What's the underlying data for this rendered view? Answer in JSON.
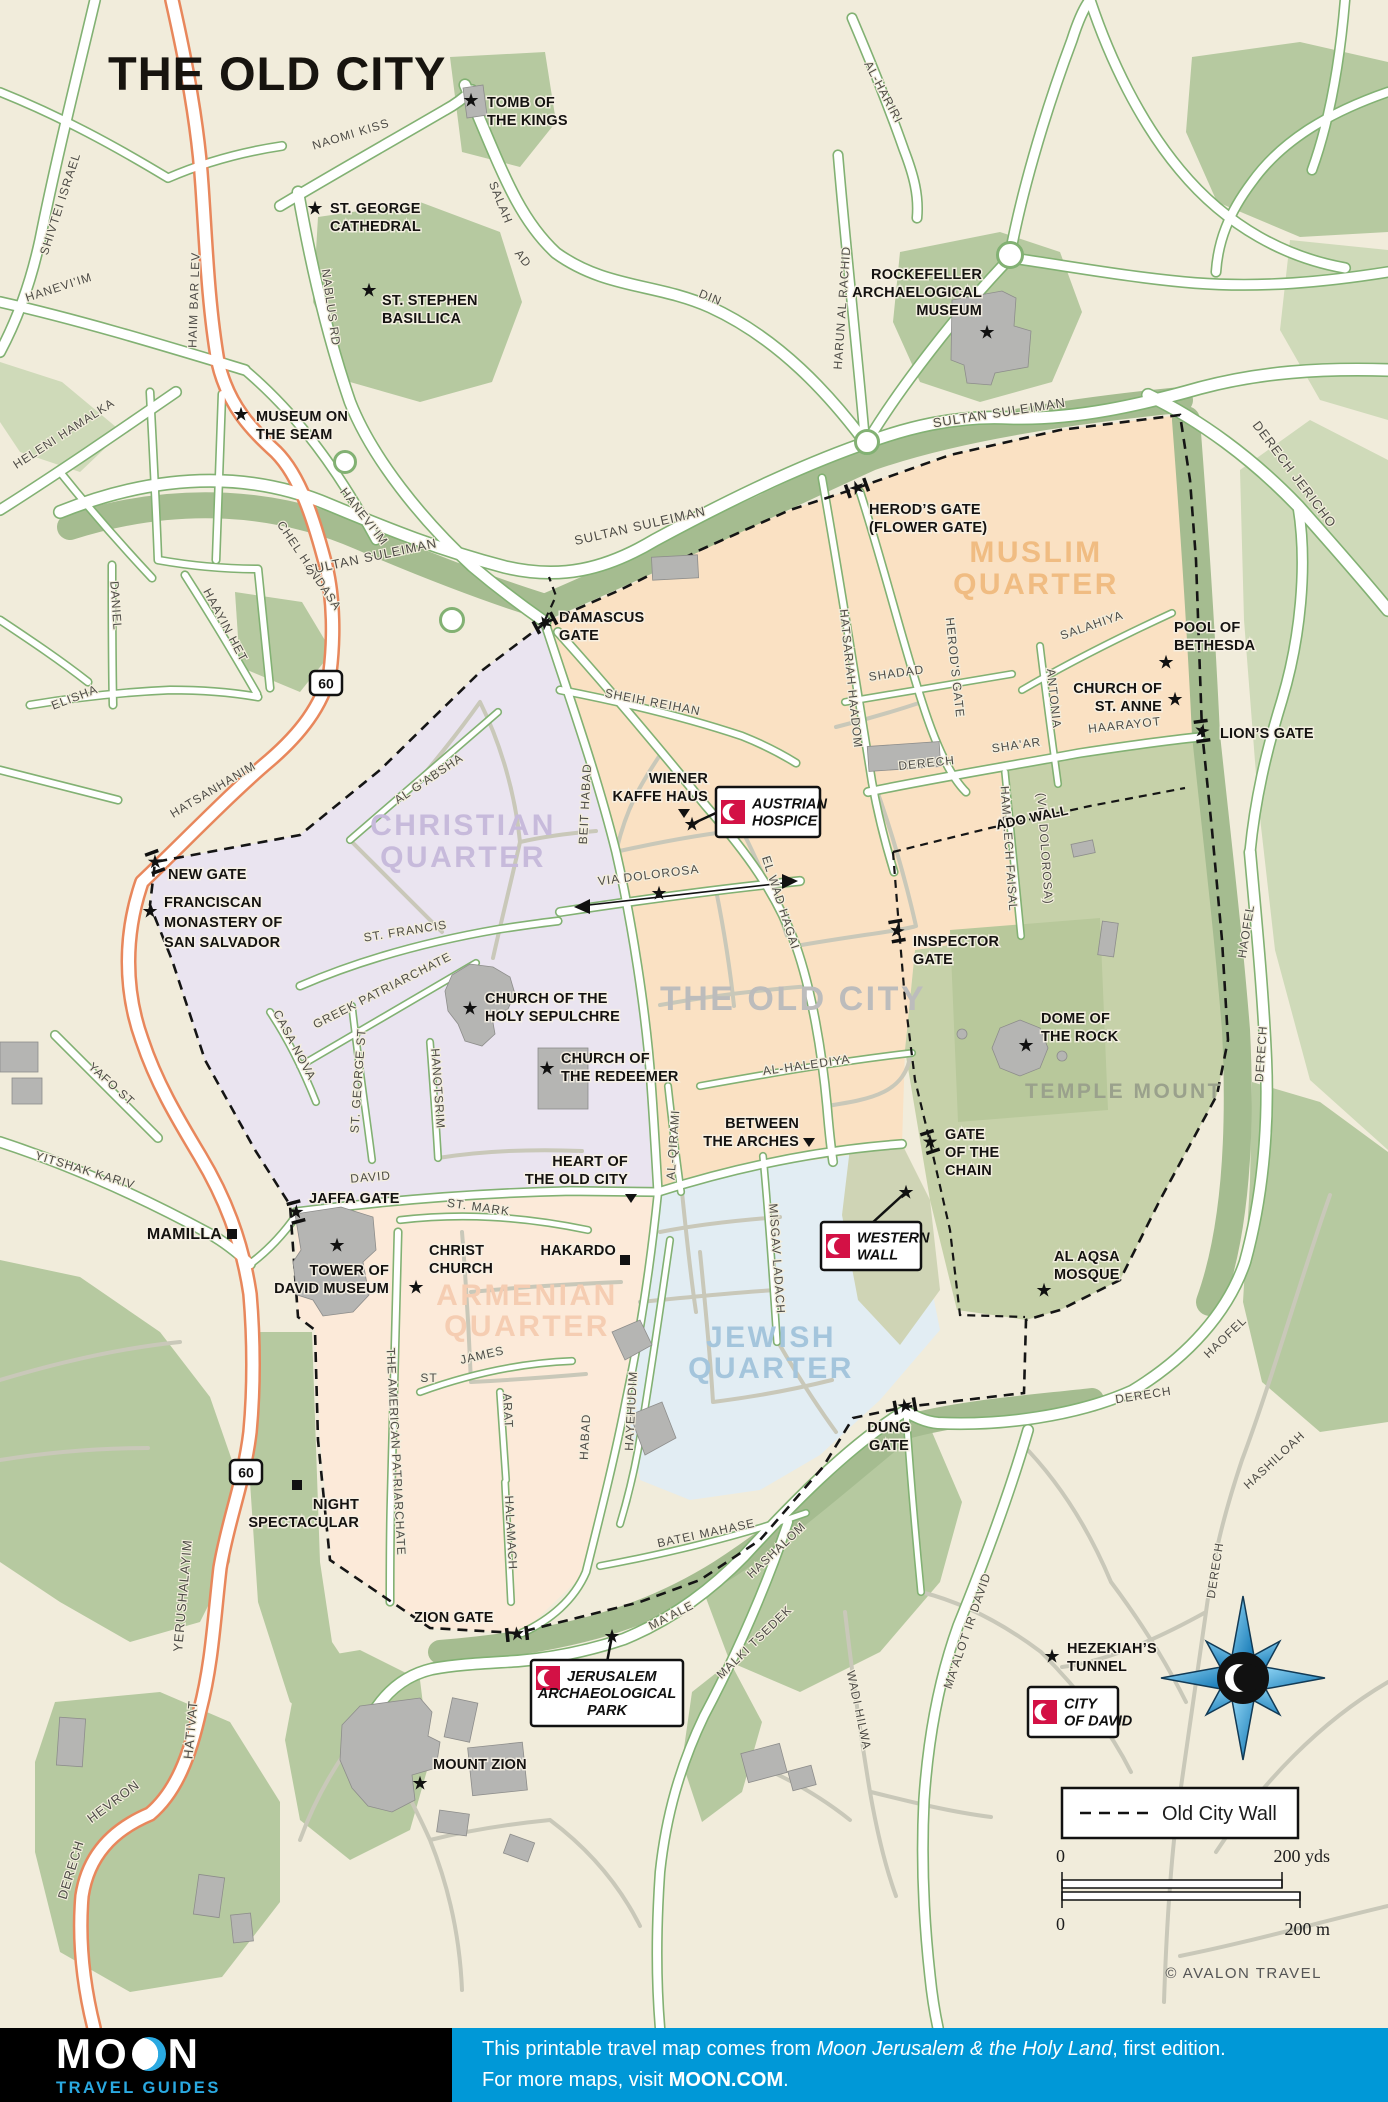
{
  "title": "THE OLD CITY",
  "copyright": "© AVALON TRAVEL",
  "colors": {
    "background": "#f1ecdb",
    "road_casing_green": "#82b173",
    "road_casing_orange": "#e8875c",
    "road_casing_pale": "#c5c8b2",
    "green_area": "#b6c9a0",
    "green_area_light": "#cfdab9",
    "green_band": "#a5bc90",
    "muslim_quarter": "#fae1c3",
    "christian_quarter": "#eae4f0",
    "armenian_quarter": "#fcead9",
    "jewish_quarter": "#e2edf3",
    "temple_mount": "#c6d1a9",
    "temple_platform": "#b8c89b",
    "western_wall_plaza": "#cfd4b5",
    "building_gray": "#b5b5b3",
    "sight_red": "#d31145",
    "footer_blue": "#0098d7",
    "logo_blue": "#2aa9e1"
  },
  "map": {
    "legend": {
      "label": "Old City Wall"
    },
    "scale": {
      "zero_top": "0",
      "yds": "200 yds",
      "zero_bottom": "0",
      "m": "200 m"
    },
    "compass": {
      "x": 1243,
      "y": 1678
    },
    "route_shields": [
      {
        "text": "60",
        "x": 326,
        "y": 683
      },
      {
        "text": "60",
        "x": 246,
        "y": 1472
      }
    ],
    "quarter_labels": [
      {
        "lines": [
          "MUSLIM",
          "QUARTER"
        ],
        "x": 1036,
        "y": 562,
        "color": "#f0bc82",
        "size": 30,
        "lh": 32
      },
      {
        "lines": [
          "CHRISTIAN",
          "QUARTER"
        ],
        "x": 463,
        "y": 835,
        "color": "#c7badb",
        "size": 30,
        "lh": 32
      },
      {
        "lines": [
          "ARMENIAN",
          "QUARTER"
        ],
        "x": 527,
        "y": 1305,
        "color": "#f5cdb2",
        "size": 30,
        "lh": 31
      },
      {
        "lines": [
          "JEWISH",
          "QUARTER"
        ],
        "x": 771,
        "y": 1347,
        "color": "#a4c5dc",
        "size": 30,
        "lh": 31
      },
      {
        "lines": [
          "THE OLD CITY"
        ],
        "x": 793,
        "y": 1010,
        "color": "#bcbcbc",
        "size": 34,
        "lh": 34
      },
      {
        "lines": [
          "TEMPLE MOUNT"
        ],
        "x": 1124,
        "y": 1098,
        "color": "#9aa18c",
        "size": 21,
        "lh": 21
      }
    ],
    "street_labels": [
      {
        "t": "NAOMI KISS",
        "x": 352,
        "y": 138,
        "r": -17
      },
      {
        "t": "SHIVTEI ISRAEL",
        "x": 64,
        "y": 205,
        "r": -72
      },
      {
        "t": "HAIM BAR LEV",
        "x": 198,
        "y": 300,
        "r": -88
      },
      {
        "t": "NABLUS RD",
        "x": 327,
        "y": 308,
        "r": 82
      },
      {
        "t": "SALAH",
        "x": 497,
        "y": 204,
        "r": 68
      },
      {
        "t": "AD",
        "x": 520,
        "y": 261,
        "r": 52
      },
      {
        "t": "DIN",
        "x": 709,
        "y": 301,
        "r": 22
      },
      {
        "t": "AL-HARIRI",
        "x": 880,
        "y": 94,
        "r": 62
      },
      {
        "t": "HARUN AL RACHID",
        "x": 846,
        "y": 308,
        "r": -86
      },
      {
        "t": "HANEVI'IM",
        "x": 60,
        "y": 291,
        "r": -18
      },
      {
        "t": "HANEVI'IM",
        "x": 361,
        "y": 519,
        "r": 52
      },
      {
        "t": "HELENI HAMALKA",
        "x": 66,
        "y": 437,
        "r": -33
      },
      {
        "t": "CHEL HANDASA",
        "x": 306,
        "y": 568,
        "r": 56
      },
      {
        "t": "DANIEL",
        "x": 112,
        "y": 606,
        "r": 86
      },
      {
        "t": "ELISHA",
        "x": 76,
        "y": 701,
        "r": -21
      },
      {
        "t": "HAAYIN HET",
        "x": 222,
        "y": 627,
        "r": 62
      },
      {
        "t": "HATSANHANIM",
        "x": 215,
        "y": 793,
        "r": -31
      },
      {
        "t": "SULTAN SULEIMAN",
        "x": 372,
        "y": 561,
        "r": -12,
        "s": 13
      },
      {
        "t": "SULTAN SULEIMAN",
        "x": 641,
        "y": 530,
        "r": -13,
        "s": 13
      },
      {
        "t": "SULTAN SULEIMAN",
        "x": 1000,
        "y": 417,
        "r": -9,
        "s": 13
      },
      {
        "t": "DERECH JERICHO",
        "x": 1291,
        "y": 477,
        "r": 53,
        "s": 13
      },
      {
        "t": "SHEIH REIHAN",
        "x": 652,
        "y": 706,
        "r": 11
      },
      {
        "t": "BEIT HABAD",
        "x": 589,
        "y": 804,
        "r": -87
      },
      {
        "t": "HATSARIAH HAADOM",
        "x": 847,
        "y": 679,
        "r": 84
      },
      {
        "t": "HEROD'S GATE",
        "x": 951,
        "y": 668,
        "r": 84
      },
      {
        "t": "SHADAD",
        "x": 897,
        "y": 677,
        "r": -8
      },
      {
        "t": "SALAHIYA",
        "x": 1093,
        "y": 629,
        "r": -19
      },
      {
        "t": "ANTONIA",
        "x": 1050,
        "y": 699,
        "r": 84
      },
      {
        "t": "DERECH",
        "x": 927,
        "y": 767,
        "r": -6
      },
      {
        "t": "SHA'AR",
        "x": 1017,
        "y": 749,
        "r": -8
      },
      {
        "t": "HAARAYOT",
        "x": 1125,
        "y": 729,
        "r": -6
      },
      {
        "t": "HAMELECH FAISAL",
        "x": 1005,
        "y": 849,
        "r": 86
      },
      {
        "t": "(VIA DOLOROSA)",
        "x": 1041,
        "y": 849,
        "r": 86
      },
      {
        "t": "EL WAD HAGAI",
        "x": 777,
        "y": 904,
        "r": 72
      },
      {
        "t": "VIA DOLOROSA",
        "x": 649,
        "y": 879,
        "r": -7
      },
      {
        "t": "AL G'ABSHA",
        "x": 431,
        "y": 782,
        "r": -34
      },
      {
        "t": "ST. FRANCIS",
        "x": 406,
        "y": 935,
        "r": -9
      },
      {
        "t": "CASA NOVA",
        "x": 291,
        "y": 1047,
        "r": 62
      },
      {
        "t": "GREEK PATRIARCHATE",
        "x": 384,
        "y": 994,
        "r": -27
      },
      {
        "t": "ST. GEORGE ST",
        "x": 362,
        "y": 1081,
        "r": -86
      },
      {
        "t": "HANOTSRIM",
        "x": 434,
        "y": 1089,
        "r": 86
      },
      {
        "t": "DAVID",
        "x": 371,
        "y": 1181,
        "r": -5
      },
      {
        "t": "ST. MARK",
        "x": 478,
        "y": 1211,
        "r": 8
      },
      {
        "t": "AL-HALEDIYA",
        "x": 807,
        "y": 1069,
        "r": -8
      },
      {
        "t": "AL-QIRAMI",
        "x": 677,
        "y": 1145,
        "r": -86
      },
      {
        "t": "MISGAV LADACH",
        "x": 773,
        "y": 1259,
        "r": 86
      },
      {
        "t": "HABAD",
        "x": 589,
        "y": 1437,
        "r": -87
      },
      {
        "t": "HAYEHUDIM",
        "x": 635,
        "y": 1411,
        "r": -87
      },
      {
        "t": "THE AMERICAN PATRIARCHATE",
        "x": 392,
        "y": 1452,
        "r": 87
      },
      {
        "t": "JAMES",
        "x": 483,
        "y": 1359,
        "r": -13
      },
      {
        "t": "ST",
        "x": 429,
        "y": 1382,
        "r": 0
      },
      {
        "t": "ARAT",
        "x": 504,
        "y": 1411,
        "r": 87
      },
      {
        "t": "HALAMACH",
        "x": 507,
        "y": 1533,
        "r": 87
      },
      {
        "t": "BATEI MAHASE",
        "x": 707,
        "y": 1537,
        "r": -12
      },
      {
        "t": "MA'ALE",
        "x": 673,
        "y": 1619,
        "r": -27
      },
      {
        "t": "HASHALOM",
        "x": 779,
        "y": 1553,
        "r": -43
      },
      {
        "t": "MALKI TSEDEK",
        "x": 757,
        "y": 1645,
        "r": -44
      },
      {
        "t": "MA'ALOT IR DAVID",
        "x": 971,
        "y": 1632,
        "r": -71
      },
      {
        "t": "WADI HILWA",
        "x": 855,
        "y": 1711,
        "r": 78
      },
      {
        "t": "HASHILOAH",
        "x": 1277,
        "y": 1463,
        "r": -43
      },
      {
        "t": "DERECH",
        "x": 1219,
        "y": 1571,
        "r": -81
      },
      {
        "t": "HAOFEL",
        "x": 1250,
        "y": 932,
        "r": -81
      },
      {
        "t": "DERECH",
        "x": 1265,
        "y": 1054,
        "r": -86
      },
      {
        "t": "DERECH",
        "x": 1144,
        "y": 1399,
        "r": -9
      },
      {
        "t": "HAOFEL",
        "x": 1228,
        "y": 1340,
        "r": -44
      },
      {
        "t": "YERUSHALAYIM",
        "x": 187,
        "y": 1596,
        "r": -85,
        "s": 13
      },
      {
        "t": "HATIVAT",
        "x": 195,
        "y": 1730,
        "r": -85,
        "s": 13
      },
      {
        "t": "HEVRON",
        "x": 116,
        "y": 1805,
        "r": -37,
        "s": 13
      },
      {
        "t": "DERECH",
        "x": 75,
        "y": 1871,
        "r": -73,
        "s": 13
      },
      {
        "t": "YAFO ST",
        "x": 109,
        "y": 1087,
        "r": 42
      },
      {
        "t": "YITSHAK KARIV",
        "x": 84,
        "y": 1174,
        "r": 17
      }
    ],
    "pois": [
      {
        "lines": [
          "TOMB OF",
          "THE KINGS"
        ],
        "x": 487,
        "y": 107,
        "m": {
          "t": "star",
          "x": 471,
          "y": 100
        }
      },
      {
        "lines": [
          "ST. GEORGE",
          "CATHEDRAL"
        ],
        "x": 330,
        "y": 213,
        "m": {
          "t": "star",
          "x": 315,
          "y": 208
        }
      },
      {
        "lines": [
          "ST. STEPHEN",
          "BASILLICA"
        ],
        "x": 382,
        "y": 305,
        "m": {
          "t": "star",
          "x": 369,
          "y": 290
        }
      },
      {
        "lines": [
          "MUSEUM ON",
          "THE SEAM"
        ],
        "x": 256,
        "y": 421,
        "m": {
          "t": "star",
          "x": 241,
          "y": 414
        }
      },
      {
        "lines": [
          "ROCKEFELLER",
          "ARCHAELOGICAL",
          "MUSEUM"
        ],
        "x": 982,
        "y": 279,
        "anchor": "end",
        "m": {
          "t": "star",
          "x": 987,
          "y": 332
        }
      },
      {
        "lines": [
          "HEROD’S GATE",
          "(FLOWER GATE)"
        ],
        "x": 869,
        "y": 514
      },
      {
        "lines": [
          "DAMASCUS",
          "GATE"
        ],
        "x": 559,
        "y": 622
      },
      {
        "lines": [
          "POOL OF",
          "BETHESDA"
        ],
        "x": 1174,
        "y": 632,
        "m": {
          "t": "star",
          "x": 1166,
          "y": 662
        }
      },
      {
        "lines": [
          "CHURCH OF",
          "ST. ANNE"
        ],
        "x": 1162,
        "y": 693,
        "anchor": "end",
        "m": {
          "t": "star",
          "x": 1175,
          "y": 699
        }
      },
      {
        "lines": [
          "LION’S GATE"
        ],
        "x": 1220,
        "y": 738
      },
      {
        "lines": [
          "NEW GATE"
        ],
        "x": 168,
        "y": 879
      },
      {
        "lines": [
          "FRANCISCAN",
          "MONASTERY OF",
          "SAN SALVADOR"
        ],
        "x": 164,
        "y": 907,
        "lh": 20,
        "m": {
          "t": "star",
          "x": 150,
          "y": 911
        }
      },
      {
        "lines": [
          "WIENER",
          "KAFFE HAUS"
        ],
        "x": 708,
        "y": 783,
        "anchor": "end",
        "m": {
          "t": "tri",
          "x": 684,
          "y": 818
        }
      },
      {
        "lines": [
          "CHURCH OF THE",
          "HOLY SEPULCHRE"
        ],
        "x": 485,
        "y": 1003,
        "m": {
          "t": "star",
          "x": 470,
          "y": 1008
        }
      },
      {
        "lines": [
          "CHURCH OF",
          "THE REDEEMER"
        ],
        "x": 561,
        "y": 1063,
        "m": {
          "t": "star",
          "x": 547,
          "y": 1068
        }
      },
      {
        "lines": [
          "INSPECTOR",
          "GATE"
        ],
        "x": 913,
        "y": 946
      },
      {
        "lines": [
          "DOME OF",
          "THE ROCK"
        ],
        "x": 1041,
        "y": 1023,
        "m": {
          "t": "star",
          "x": 1026,
          "y": 1045
        }
      },
      {
        "lines": [
          "BETWEEN",
          "THE ARCHES"
        ],
        "x": 799,
        "y": 1128,
        "anchor": "end",
        "m": {
          "t": "tri",
          "x": 809,
          "y": 1147
        }
      },
      {
        "lines": [
          "HEART OF",
          "THE OLD CITY"
        ],
        "x": 628,
        "y": 1166,
        "anchor": "end",
        "m": {
          "t": "tri",
          "x": 631,
          "y": 1203
        }
      },
      {
        "lines": [
          "GATE",
          "OF THE",
          "CHAIN"
        ],
        "x": 945,
        "y": 1139
      },
      {
        "lines": [
          "AL AQSA",
          "MOSQUE"
        ],
        "x": 1054,
        "y": 1261,
        "m": {
          "t": "star",
          "x": 1044,
          "y": 1290
        }
      },
      {
        "lines": [
          "JAFFA GATE"
        ],
        "x": 309,
        "y": 1203
      },
      {
        "lines": [
          "MAMILLA"
        ],
        "x": 222,
        "y": 1239,
        "anchor": "end",
        "size": 16,
        "m": {
          "t": "sq",
          "x": 232,
          "y": 1234
        }
      },
      {
        "lines": [
          "TOWER OF",
          "DAVID MUSEUM"
        ],
        "x": 389,
        "y": 1275,
        "anchor": "end",
        "m": {
          "t": "star",
          "x": 337,
          "y": 1245
        }
      },
      {
        "lines": [
          "CHRIST",
          "CHURCH"
        ],
        "x": 429,
        "y": 1255,
        "m": {
          "t": "star",
          "x": 416,
          "y": 1287
        }
      },
      {
        "lines": [
          "HAKARDO"
        ],
        "x": 616,
        "y": 1255,
        "anchor": "end",
        "m": {
          "t": "sq",
          "x": 625,
          "y": 1260
        }
      },
      {
        "lines": [
          "NIGHT",
          "SPECTACULAR"
        ],
        "x": 359,
        "y": 1509,
        "anchor": "end",
        "m": {
          "t": "sq",
          "x": 297,
          "y": 1485
        }
      },
      {
        "lines": [
          "ZION GATE"
        ],
        "x": 414,
        "y": 1622
      },
      {
        "lines": [
          "DUNG",
          "GATE"
        ],
        "x": 889,
        "y": 1432,
        "anchor": "middle"
      },
      {
        "lines": [
          "HEZEKIAH’S",
          "TUNNEL"
        ],
        "x": 1067,
        "y": 1653,
        "m": {
          "t": "star",
          "x": 1052,
          "y": 1656
        }
      },
      {
        "lines": [
          "MOUNT ZION"
        ],
        "x": 433,
        "y": 1769,
        "m": {
          "t": "star",
          "x": 420,
          "y": 1783
        }
      },
      {
        "lines": [
          "ADO WALL"
        ],
        "x": 1033,
        "y": 822,
        "anchor": "middle",
        "r": -12,
        "size": 13.5
      },
      {
        "name": "via-dolorosa-station",
        "lines": [],
        "x": 659,
        "y": 895,
        "m": {
          "t": "star",
          "x": 659,
          "y": 893
        }
      }
    ],
    "gates": [
      {
        "x": 545,
        "y": 623,
        "a": -28
      },
      {
        "x": 857,
        "y": 488,
        "a": -20
      },
      {
        "x": 1202,
        "y": 731,
        "a": 82
      },
      {
        "x": 155,
        "y": 862,
        "a": 70
      },
      {
        "x": 296,
        "y": 1212,
        "a": 75
      },
      {
        "x": 517,
        "y": 1634,
        "a": -6
      },
      {
        "x": 905,
        "y": 1406,
        "a": -10
      },
      {
        "x": 930,
        "y": 1142,
        "a": 72
      },
      {
        "x": 897,
        "y": 931,
        "a": 80
      }
    ],
    "badges": [
      {
        "lines": [
          "AUSTRIAN",
          "HOSPICE"
        ],
        "x": 716,
        "y": 787,
        "w": 104,
        "h": 50,
        "star": {
          "x": 692,
          "y": 824
        },
        "tx": 718,
        "ty": 812
      },
      {
        "lines": [
          "WESTERN",
          "WALL"
        ],
        "x": 821,
        "y": 1222,
        "w": 100,
        "h": 48,
        "star": {
          "x": 906,
          "y": 1192
        },
        "tx": 871,
        "ty": 1224
      },
      {
        "lines": [
          "JERUSALEM",
          "ARCHAEOLOGICAL",
          "PARK"
        ],
        "x": 531,
        "y": 1660,
        "w": 152,
        "h": 66,
        "star": {
          "x": 612,
          "y": 1636
        },
        "tx": 607,
        "ty": 1662
      },
      {
        "lines": [
          "CITY",
          "OF DAVID"
        ],
        "x": 1028,
        "y": 1687,
        "w": 90,
        "h": 50
      }
    ]
  },
  "footer": {
    "brand": {
      "name_prefix": "MO",
      "name_suffix": "N",
      "tagline": "TRAVEL GUIDES"
    },
    "line1_pre": "This printable travel map comes from ",
    "line1_title": "Moon Jerusalem & the Holy Land",
    "line1_post": ", first edition.",
    "line2_pre": "For more maps, visit ",
    "line2_link": "MOON.COM",
    "line2_post": "."
  }
}
